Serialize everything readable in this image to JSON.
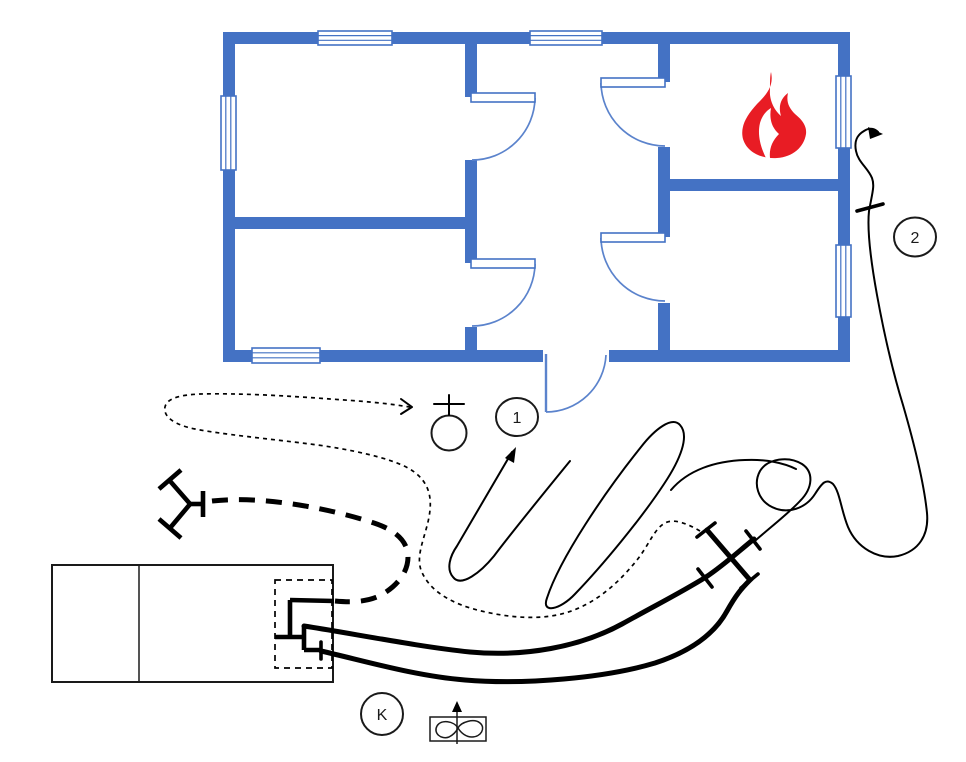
{
  "canvas": {
    "width": 966,
    "height": 762,
    "background": "#FFFFFF"
  },
  "colors": {
    "wall_blue": "#4472C4",
    "door_arc_blue": "#5B83CC",
    "fire_red": "#E81C24",
    "line_ink": "#000000"
  },
  "labels": {
    "circle_1": "1",
    "circle_2": "2",
    "circle_k": "K"
  },
  "symbols": {
    "fire": "flame-icon",
    "hydrant": "hydrant-icon",
    "distributor": "hose-distributor-icon",
    "fan": "ventilation-fan-icon",
    "engine": "fire-engine-rect",
    "couplings": "hose-coupling-ticks",
    "attack_route": "dotted-route-arrow",
    "supply_line": "thick-dashed-hose"
  }
}
